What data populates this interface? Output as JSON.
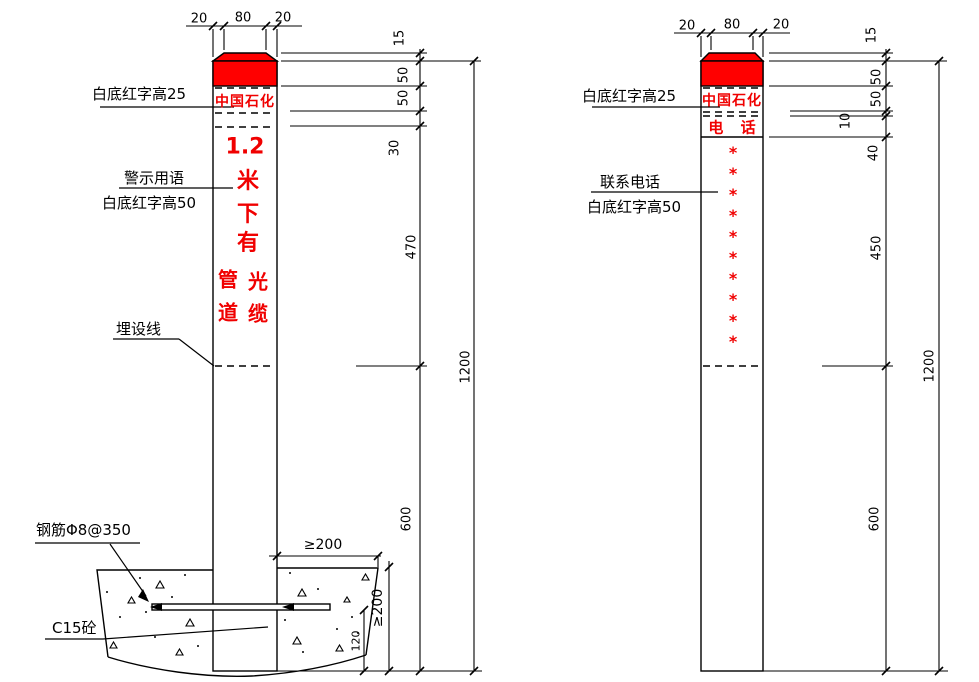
{
  "drawing": {
    "accent_red": "#ff0000",
    "line_color": "#000000",
    "background": "#ffffff"
  },
  "left_post": {
    "top_dims": [
      "20",
      "80",
      "20"
    ],
    "brand_text": "中国石化",
    "warning": {
      "row_number": "1.2",
      "column": [
        "米",
        "下",
        "有"
      ],
      "left_column": [
        "管",
        "道"
      ],
      "right_column": [
        "光",
        "缆"
      ]
    },
    "labels": {
      "band_note": "白底红字高25",
      "warning_note_line1": "警示用语",
      "warning_note_line2": "白底红字高50",
      "burial_line": "埋设线",
      "rebar": "钢筋Φ8@350",
      "concrete": "C15砼"
    },
    "side_dims": [
      "15",
      "50",
      "50",
      "30",
      "470",
      "600"
    ],
    "overall_dim": "1200",
    "foundation_dims": {
      "width": "≥200",
      "depth": "≥200",
      "rebar_offset": "120"
    }
  },
  "right_post": {
    "top_dims": [
      "20",
      "80",
      "20"
    ],
    "brand_text": "中国石化",
    "phone_header": "电 话",
    "asterisks": [
      "*",
      "*",
      "*",
      "*",
      "*",
      "*",
      "*",
      "*",
      "*",
      "*"
    ],
    "labels": {
      "band_note": "白底红字高25",
      "phone_note_line1": "联系电话",
      "phone_note_line2": "白底红字高50"
    },
    "side_dims": [
      "15",
      "50",
      "50",
      "10",
      "40",
      "450",
      "600"
    ],
    "overall_dim": "1200"
  }
}
